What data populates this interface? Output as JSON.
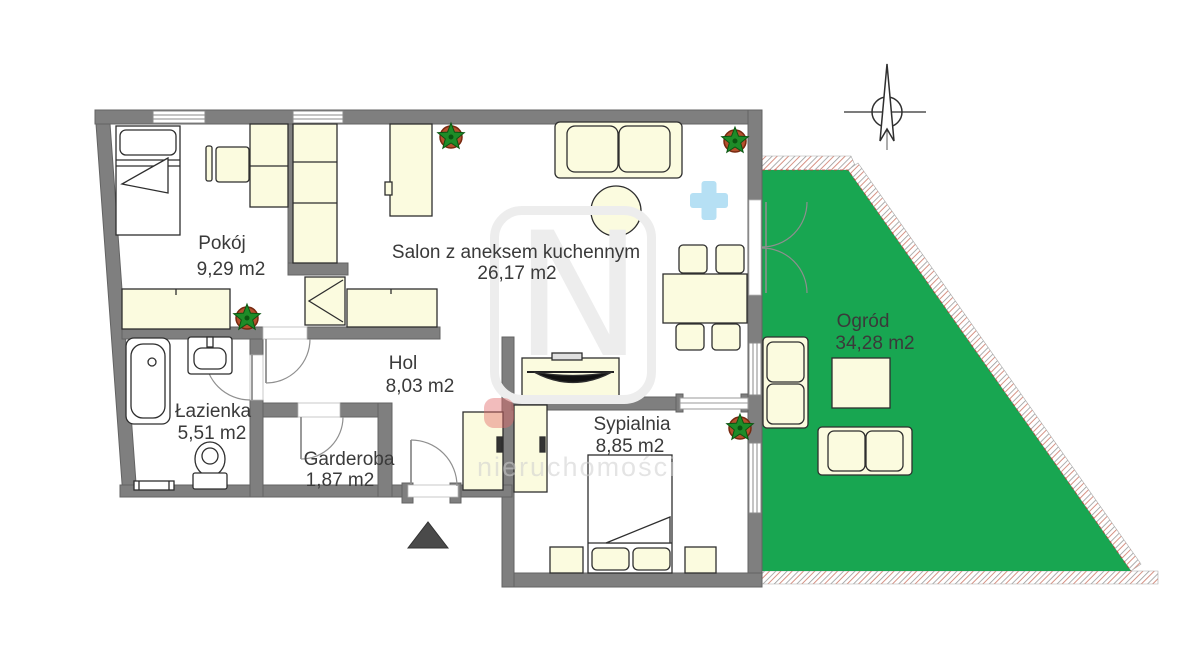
{
  "floorplan": {
    "rooms": [
      {
        "name": "Pokój",
        "area": "9,29 m2"
      },
      {
        "name": "Salon z aneksem kuchennym",
        "area": "26,17 m2"
      },
      {
        "name": "Hol",
        "area": "8,03 m2"
      },
      {
        "name": "Łazienka",
        "area": "5,51 m2"
      },
      {
        "name": "Garderoba",
        "area": "1,87 m2"
      },
      {
        "name": "Sypialnia",
        "area": "8,85 m2"
      },
      {
        "name": "Ogród",
        "area": "34,28 m2"
      }
    ],
    "watermark": {
      "letter": "N",
      "text": "nieruchomości"
    },
    "icons": [
      "north-arrow-icon",
      "entrance-triangle-icon",
      "plant-icon",
      "plus-icon"
    ],
    "colors": {
      "garden_green": "#18a651",
      "wall_gray": "#7f7f7f",
      "furniture_cream": "#fbfbdf",
      "fixture_white": "#ffffff",
      "plus_blue": "#b6e0f4",
      "plant_pot": "#b5502e",
      "plant_leaf": "#1e8c28",
      "label_text": "#3a3a3a",
      "entrance_marker": "#4a4a4a",
      "hatch_line": "#9a9a9a"
    }
  }
}
